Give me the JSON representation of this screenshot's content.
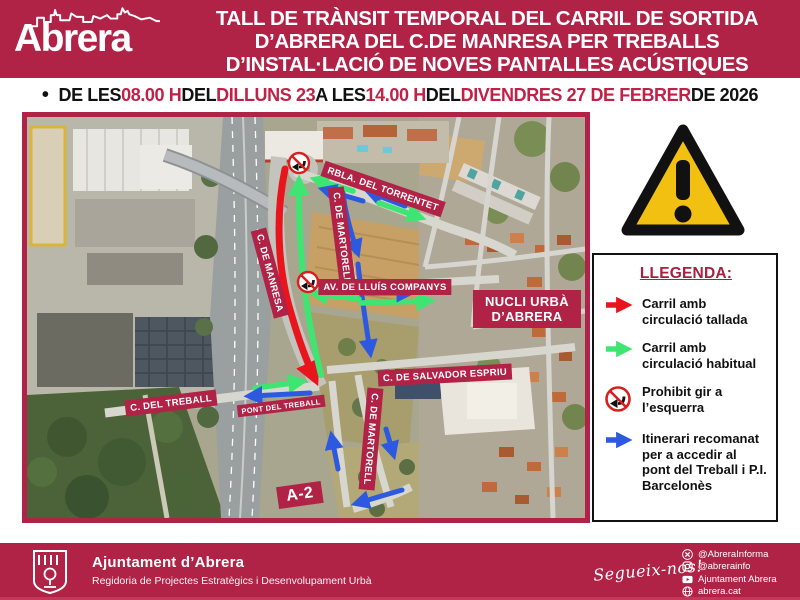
{
  "logo": {
    "name": "Abrera"
  },
  "header": {
    "title_line1": "TALL DE TRÀNSIT TEMPORAL DEL CARRIL DE SORTIDA",
    "title_line2": "D’ABRERA DEL C.DE MANRESA PER TREBALLS",
    "title_line3": "D’INSTAL·LACIÓ DE NOVES PANTALLES ACÚSTIQUES"
  },
  "date_line": {
    "bullet": "•",
    "p1": "DE LES ",
    "h1": "08.00 H",
    "p2": " DEL ",
    "h2": "DILLUNS 23",
    "p3": " A LES ",
    "h3": "14.00 H",
    "p4": " DEL ",
    "h4": "DIVENDRES 27 DE FEBRER",
    "p5": " DE 2026"
  },
  "map": {
    "labels": {
      "manresa": "C. DE MANRESA",
      "torrentet": "RBLA. DEL TORRENTET",
      "martorell_top": "C. DE MARTORELL",
      "companys": "AV. DE LLUÍS COMPANYS",
      "nucli": "NUCLI URBÀ D’ABRERA",
      "espriu": "C. DE SALVADOR ESPRIU",
      "treball": "C. DEL TREBALL",
      "pont": "PONT DEL TREBALL",
      "martorell_bottom": "C. DE MARTORELL",
      "a2": "A-2"
    },
    "annotation_colors": {
      "closed_lane": "#e8151d",
      "normal_lane": "#3fe572",
      "recommended_route": "#2c59e0",
      "label_badge": "#b02347"
    }
  },
  "legend": {
    "title": "LLEGENDA:",
    "items": [
      {
        "icon": "red-arrow",
        "text": "Carril amb circulació tallada"
      },
      {
        "icon": "green-arrow",
        "text": "Carril amb circulació habitual"
      },
      {
        "icon": "no-left-turn-sign",
        "text": "Prohibit gir a l’esquerra"
      },
      {
        "icon": "blue-arrow",
        "text": "Itinerari recomanat per a accedir al pont del Treball i P.I. Barcelonès"
      }
    ]
  },
  "footer": {
    "org_name": "Ajuntament d’Abrera",
    "org_dept": "Regidoria de Projectes Estratègics i Desenvolupament Urbà",
    "follow": "Segueix-nos!",
    "social": [
      {
        "icon": "x-icon",
        "label": "@AbreraInforma"
      },
      {
        "icon": "instagram-icon",
        "label": "@abrerainfo"
      },
      {
        "icon": "youtube-icon",
        "label": "Ajuntament Abrera"
      },
      {
        "icon": "globe-icon",
        "label": "abrera.cat"
      }
    ]
  }
}
